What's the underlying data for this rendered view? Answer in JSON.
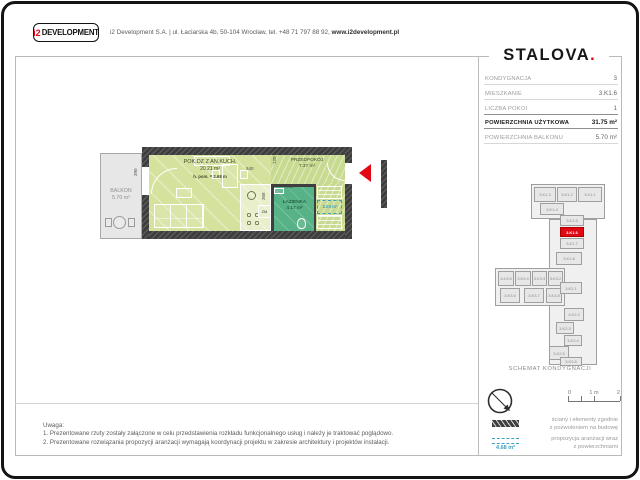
{
  "header": {
    "logo": {
      "i2": "i2",
      "development": "DEVELOPMENT"
    },
    "contact": "i2 Development S.A.  |  ul. Łaciarska 4b, 50-104 Wrocław, tel. +48 71 797 88 92, ",
    "website": "www.i2development.pl"
  },
  "brand": {
    "name": "STALOVA",
    "dot": "."
  },
  "details": {
    "rows": [
      {
        "label": "KONDYGNACJA",
        "value": "3",
        "bold": false
      },
      {
        "label": "MIESZKANIE",
        "value": "3.K1.6",
        "bold": false
      },
      {
        "label": "LICZBA POKOI",
        "value": "1",
        "bold": false
      },
      {
        "label": "POWIERZCHNIA UŻYTKOWA",
        "value": "31.75 m²",
        "bold": true
      },
      {
        "label": "POWIERZCHNIA BALKONU",
        "value": "5.70 m²",
        "bold": false
      }
    ]
  },
  "floorplan": {
    "balcony_name": "BALKON",
    "balcony_area": "5.70 m²",
    "living_name": "POK.DZ Z AN.KUCH.",
    "living_area": "20.21 m²",
    "living_height": "h. pom. = 2.68 m",
    "hall_name": "PRZEDPOKÓJ",
    "hall_area": "7.37 m²",
    "bath_name": "ŁAZIENKA",
    "bath_area": "4.17 m²",
    "proposal_area": "2.03 m²",
    "washer_label": "ZM",
    "dimensions": [
      "390",
      "540",
      "368",
      "210",
      "120"
    ]
  },
  "schematic": {
    "caption": "SCHEMAT KONDYGNACJI",
    "highlighted_unit": "3.K1.6",
    "units": [
      "3.K1.3",
      "3.K1.2",
      "3.K1.1",
      "3.K1.4",
      "3.K1.5",
      "3.K1.6",
      "3.K1.7",
      "3.K1.8",
      "3.K3.5",
      "3.K3.4",
      "3.K3.3",
      "3.K3.2",
      "3.K3.6",
      "3.K3.7",
      "3.K3.8",
      "3.K2.1",
      "3.K2.2",
      "3.K2.3",
      "3.K2.4",
      "3.K2.5",
      "3.K2.6"
    ]
  },
  "notes": {
    "title": "Uwaga:",
    "items": [
      "1. Prezentowane rzuty zostały załączone w celu przedstawienia rozkładu funkcjonalnego usług i należy je traktować poglądowo.",
      "2. Prezentowane rozwiązania propozycji aranżacji wymagają koordynacji projektu w zakresie architektury i projektów instalacji."
    ]
  },
  "legend": {
    "scale": {
      "start": "0",
      "mid": "1 m",
      "end": "2"
    },
    "walls": {
      "line1": "ściany i elementy zgodnie",
      "line2": "z pozwoleniem na budowę"
    },
    "proposal": {
      "area": "4.68 m²",
      "line1": "propozycja aranżacji wraz",
      "line2": "z powierzchniami"
    }
  },
  "colors": {
    "accent_red": "#e30613",
    "plan_green": "#d5e29e",
    "hall_green": "#c7da90",
    "bath_green": "#57b287",
    "proposal_teal": "#3d9fc0",
    "wall_dark": "#3e3e3e"
  }
}
